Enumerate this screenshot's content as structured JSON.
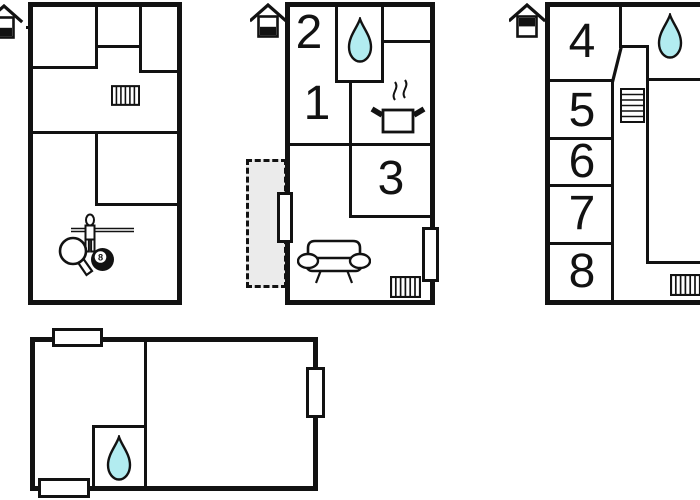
{
  "colors": {
    "background": "#ffffff",
    "line": "#121212",
    "drop_fill": "#b2ecf0",
    "terrace_fill": "#ebebeb"
  },
  "plans": {
    "basement": {
      "level_icon": "house-basement-icon",
      "rooms": {},
      "features": [
        "radiator-icon",
        "foosball-player-icon",
        "table-tennis-paddle-icon",
        "billiard-8-ball-icon"
      ]
    },
    "ground_floor": {
      "level_icon": "house-ground-floor-icon",
      "rooms": {
        "r1": "1",
        "r2": "2",
        "r3": "3"
      },
      "features": [
        "water-drop-icon",
        "cooking-pot-icon",
        "sofa-icon",
        "radiator-icon",
        "terrace-area",
        "window-marker"
      ]
    },
    "upper_floor": {
      "level_icon": "house-upper-floor-icon",
      "rooms": {
        "r4": "4",
        "r5": "5",
        "r6": "6",
        "r7": "7",
        "r8": "8"
      },
      "features": [
        "water-drop-icon",
        "stairs-icon",
        "radiator-icon"
      ]
    },
    "annex": {
      "rooms": {},
      "features": [
        "water-drop-icon",
        "window-marker"
      ]
    }
  },
  "billiard_ball": {
    "number": "8"
  }
}
